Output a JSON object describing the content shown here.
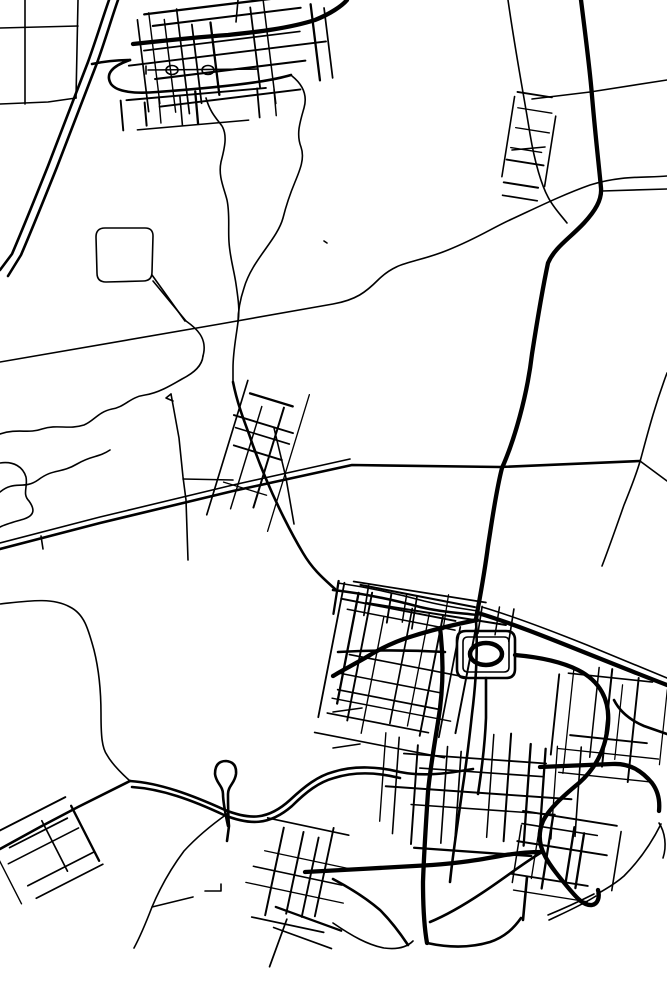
{
  "canvas": {
    "width": 667,
    "height": 1000,
    "background": "#ffffff",
    "ink": "#000000"
  },
  "map": {
    "seed": 7,
    "stroke_widths": {
      "thin": 1.6,
      "med": 2.6,
      "thick": 4.3,
      "pond": 4.5,
      "cluster_minor_min": 1.25,
      "cluster_minor_var": 0.8,
      "cluster_major": 2.3
    },
    "roads": {
      "thick": [
        "M581,0 C586,40 590,70 592,96 C596,142 599,166 601,188 C602,200 595,211 584,223 C569,239 555,247 548,263 C542,291 537,322 532,354 C527,397 514,441 502,468 C496,491 492,521 488,546 C484,577 479,602 476,619",
        "M133,44 C170,40 200,37 228,35 C258,32 290,28 315,20 C330,14 342,6 347,0",
        "M477,620 C452,625 432,630 413,636 C396,641 381,648 365,658 C351,666 341,671 333,676",
        "M440,628 C444,660 443,692 438,722 C434,747 430,770 428,792 C426,822 424,852 423,882 C423,906 424,926 427,943",
        "M515,655 C538,657 560,661 578,670 C600,681 610,700 608,724 C606,748 596,768 579,783 C562,797 549,809 543,821 C538,833 539,845 545,856 C550,866 560,878 571,891 C577,898 584,906 592,905 C598,904 600,897 598,890",
        "M305,872 C340,870 400,867 432,865 C460,863 478,860 500,856 C516,853 530,852 542,852",
        "M478,613 C511,623 546,637 581,651 C616,665 646,677 667,685",
        "M540,767 L612,764 C630,763 642,771 652,783 C658,791 660,801 659,811"
      ],
      "med": [
        "M109,0 C102,20 96,40 88,62 C76,94 62,130 48,166 C36,196 24,226 12,254 L0,270",
        "M118,0 C111,20 105,41 97,63 C85,95 71,131 57,167 C45,197 33,227 21,255 L8,276",
        "M92,64 C106,61 118,60 130,60",
        "M130,60 C112,66 105,74 111,84 C117,92 135,94 157,92 C184,90 224,87 257,82 C270,80 281,78 291,75",
        "M233,382 C237,402 243,418 249,434 C259,464 271,492 284,518 C291,532 297,543 303,553 C313,570 324,579 335,589",
        "M0,549 L100,523 L233,491 L352,465 L500,467 L640,461",
        "M130,781 L78,807 L40,827 L0,849",
        "M130,781 C160,783 192,795 225,810 C250,820 268,820 290,800 C305,786 318,776 333,772 C355,765 380,767 400,772 C425,777 450,773 473,769",
        "M132,787 C162,789 192,800 224,815 C249,825 269,826 292,806 C306,792 319,782 334,778 C356,771 380,773 400,778",
        "M476,621 C478,652 476,682 472,714 C469,742 466,766 462,792 C458,822 453,852 450,882",
        "M466,631 L506,631 Q515,631 515,640 L515,669 Q515,678 506,678 L466,678 Q457,678 457,669 L457,640 Q457,631 466,631",
        "M333,590 C360,593 390,599 420,607 C446,613 463,613 477,615",
        "M542,852 C522,864 502,880 482,893 C464,905 447,915 430,922",
        "M486,678 L486,718 C485,744 482,768 478,794",
        "M614,700 C620,712 630,720 644,726 L667,734",
        "M427,943 C450,948 470,948 490,942 C505,937 514,928 521,918",
        "M333,879 C350,888 366,898 380,910 C391,921 400,933 408,945",
        "M338,652 C372,650 410,650 445,652",
        "M527,877 L523,920",
        "M228,826 C225,812 223,802 223,794 C223,786 216,783 215,774 Q215,761 226,761 Q237,762 236,774 C235,783 228,786 228,794 C228,804 228,814 229,826 L227,841"
      ],
      "thin": [
        "M25,0 L25,104",
        "M78,0 L76,98",
        "M0,28 L78,26",
        "M0,104 L48,102 L76,98",
        "M292,76 C302,84 308,94 304,108 C300,122 296,134 301,147 C305,158 300,170 295,182 C290,194 286,206 283,218 C277,240 252,260 244,288 C240,300 238,310 238,322",
        "M206,98 C210,112 216,118 222,126 C228,136 224,150 221,162 C218,176 224,188 227,200 C230,214 228,228 229,242 C230,258 234,270 236,284 C238,298 240,310 238,322 C236,338 233,352 233,368 L233,382",
        "M0,362 C60,352 140,338 220,324 C260,317 300,310 333,304 C356,300 366,292 378,280 C398,260 414,264 448,250 C478,238 492,228 512,219 C538,207 562,195 590,185 C622,175 646,178 667,176",
        "M532,99 L590,92 L667,80",
        "M602,191 L667,189",
        "M508,0 C516,56 524,96 530,134 C535,164 542,186 548,197 C553,207 560,214 567,223",
        "M667,373 C655,405 648,432 641,458 C636,476 630,490 624,505 C618,522 610,545 602,566",
        "M640,461 L667,481",
        "M0,543 L100,517 L233,485 L350,459",
        "M0,434 C18,428 28,434 42,429 C58,424 68,430 84,425 C94,421 98,412 112,409 C125,407 130,397 145,395 C158,393 170,386 182,379 C194,373 202,366 203,356",
        "M203,356 C208,338 196,328 186,321 L153,281",
        "M0,492 C14,480 24,490 38,480 C54,468 60,474 77,464 C92,455 98,458 110,450",
        "M0,463 C14,461 23,467 26,477 C28,487 22,494 29,501 C34,508 36,515 24,519 C14,522 6,524 0,527",
        "M105,228 L145,228 Q153,228 153,236 L152,272 Q152,281 143,281 L106,282 Q97,282 97,273 L96,237 Q96,228 105,228",
        "M152,275 L185,321",
        "M171,394 L179,438 L183,477 L186,500 L188,560",
        "M171,394 L166,398 L173,401",
        "M183,479 L233,480",
        "M274,428 L286,478 L294,524",
        "M0,604 C28,601 52,597 70,607 C84,614 88,628 94,650 C99,670 101,692 101,714 C101,736 102,748 107,755 C112,764 120,772 130,781",
        "M227,814 C210,826 196,838 184,851 C172,867 160,888 152,907 C147,920 141,935 134,948",
        "M152,907 L193,897",
        "M205,891 L221,891 L221,884",
        "M333,923 C352,936 368,945 384,948 C399,950 408,946 413,941",
        "M324,241 L327,243",
        "M659,823 C665,832 667,846 663,858",
        "M41,536 L43,549",
        "M338,583 C365,587 395,593 424,601 C448,607 465,609 478,611",
        "M482,607 C516,617 552,631 587,645 C621,659 650,671 667,678",
        "M468,637 L504,637 Q509,637 509,642 L509,667 Q509,672 504,672 L468,672 Q463,672 463,667 L463,642 Q463,637 468,637",
        "M238,0 L236,22",
        "M146,66 L146,74",
        "M148,70 L258,69",
        "M512,150 L545,147",
        "M333,712 L362,708",
        "M333,748 L360,744",
        "M548,915 C565,908 580,901 594,894",
        "M549,920 C566,912 582,905 596,896",
        "M597,894 C608,888 616,883 624,876 C640,860 652,842 661,824"
      ]
    },
    "ellipses": [
      {
        "name": "pond",
        "cx": 486,
        "cy": 654,
        "rx": 16,
        "ry": 11,
        "width_key": "pond"
      },
      {
        "name": "plaza-oval",
        "cx": 172,
        "cy": 70,
        "rx": 6,
        "ry": 4.5,
        "width_key": "thin"
      },
      {
        "name": "plaza-oval",
        "cx": 208,
        "cy": 70,
        "rx": 6,
        "ry": 4.5,
        "width_key": "thin"
      }
    ],
    "clusters": [
      {
        "cx": 228,
        "cy": 56,
        "w": 200,
        "h": 112,
        "rot": -7,
        "nx": 15,
        "ny": 7,
        "skip": 0.2
      },
      {
        "cx": 200,
        "cy": 108,
        "w": 150,
        "h": 34,
        "rot": -5,
        "nx": 9,
        "ny": 2,
        "skip": 0.3
      },
      {
        "cx": 527,
        "cy": 146,
        "w": 46,
        "h": 112,
        "rot": 9,
        "nx": 3,
        "ny": 7,
        "skip": 0.35
      },
      {
        "cx": 254,
        "cy": 455,
        "w": 64,
        "h": 148,
        "rot": 17,
        "nx": 4,
        "ny": 9,
        "skip": 0.3
      },
      {
        "cx": 47,
        "cy": 851,
        "w": 92,
        "h": 76,
        "rot": -27,
        "nx": 6,
        "ny": 6,
        "skip": 0.32
      },
      {
        "cx": 397,
        "cy": 668,
        "w": 138,
        "h": 152,
        "rot": 11,
        "nx": 10,
        "ny": 11,
        "skip": 0.16
      },
      {
        "cx": 424,
        "cy": 611,
        "w": 172,
        "h": 40,
        "rot": 9,
        "nx": 12,
        "ny": 3,
        "skip": 0.26
      },
      {
        "cx": 478,
        "cy": 790,
        "w": 192,
        "h": 122,
        "rot": 4,
        "nx": 13,
        "ny": 9,
        "skip": 0.18
      },
      {
        "cx": 608,
        "cy": 722,
        "w": 112,
        "h": 118,
        "rot": 6,
        "nx": 9,
        "ny": 9,
        "skip": 0.2
      },
      {
        "cx": 300,
        "cy": 876,
        "w": 112,
        "h": 108,
        "rot": 12,
        "nx": 8,
        "ny": 7,
        "skip": 0.28
      },
      {
        "cx": 558,
        "cy": 856,
        "w": 112,
        "h": 82,
        "rot": 9,
        "nx": 8,
        "ny": 6,
        "skip": 0.3
      },
      {
        "cx": 300,
        "cy": 950,
        "w": 90,
        "h": 60,
        "rot": 20,
        "nx": 6,
        "ny": 4,
        "skip": 0.35
      }
    ]
  }
}
